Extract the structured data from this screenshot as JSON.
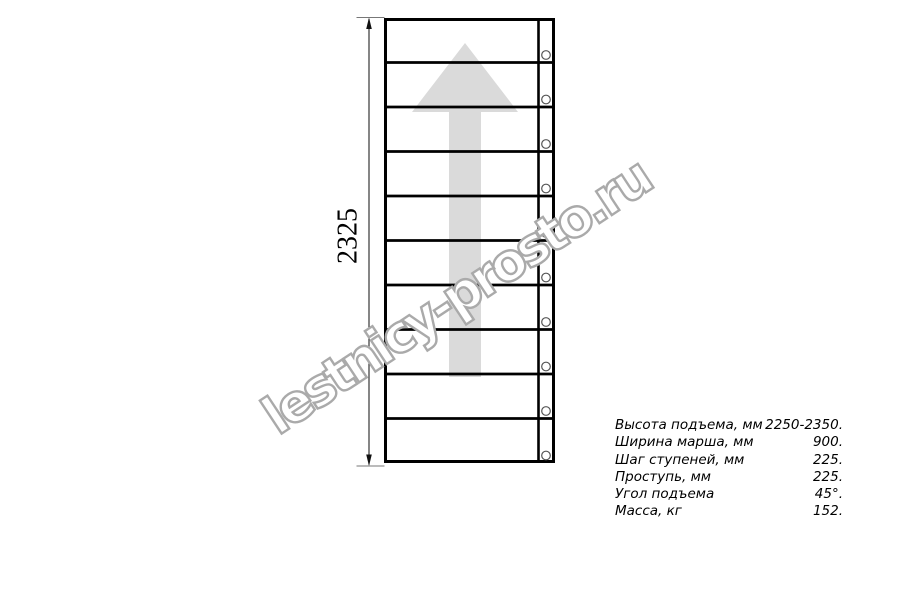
{
  "drawing": {
    "dimension_label": "2325",
    "watermark_text": "lestnicy-prosto.ru",
    "ladder": {
      "steps": 10,
      "direction": "up"
    },
    "colors": {
      "line": "#000000",
      "thin_line": "#555555",
      "arrow_fill": "#dadada",
      "watermark_stroke": "#aaaaaa",
      "watermark_fill": "#ffffff",
      "hole_stroke": "#555555"
    }
  },
  "specs": {
    "rows": [
      {
        "label": "Высота подъема, мм",
        "value": "2250-2350."
      },
      {
        "label": "Ширина марша, мм",
        "value": "900."
      },
      {
        "label": "Шаг ступеней, мм",
        "value": "225."
      },
      {
        "label": "Проступь, мм",
        "value": "225."
      },
      {
        "label": "Угол подъема",
        "value": "45°."
      },
      {
        "label": "Масса, кг",
        "value": "152."
      }
    ]
  }
}
